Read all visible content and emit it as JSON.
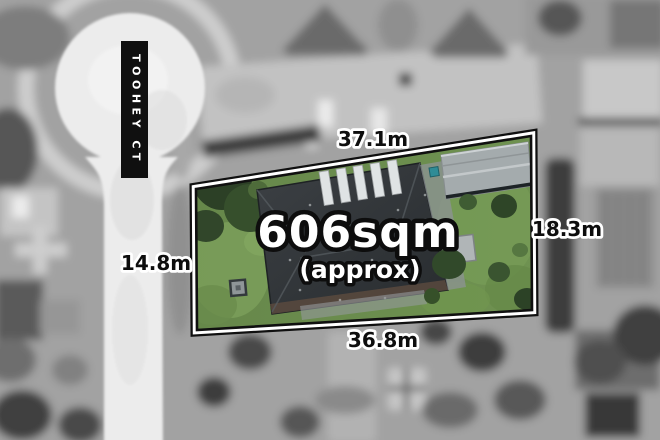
{
  "labels": {
    "street": "TOOHEY CT",
    "area": "606sqm",
    "approx": "(approx)",
    "dim_top": "37.1m",
    "dim_right": "18.3m",
    "dim_bottom": "36.8m",
    "dim_left": "14.8m"
  },
  "colors": {
    "boundary_outline": "#ffffff",
    "boundary_edge": "#101010",
    "dimension_text": "#0d0d0d",
    "dimension_halo": "#ffffff",
    "area_text": "#ffffff",
    "area_outline": "#0d0d0d",
    "street_label_bg": "#101010",
    "street_label_text": "#ffffff",
    "road": "#ececec",
    "lawn": "#69894d",
    "house_roof": "#33373a",
    "shed_roof": "#a4abad",
    "pool": "#2f8c96"
  }
}
